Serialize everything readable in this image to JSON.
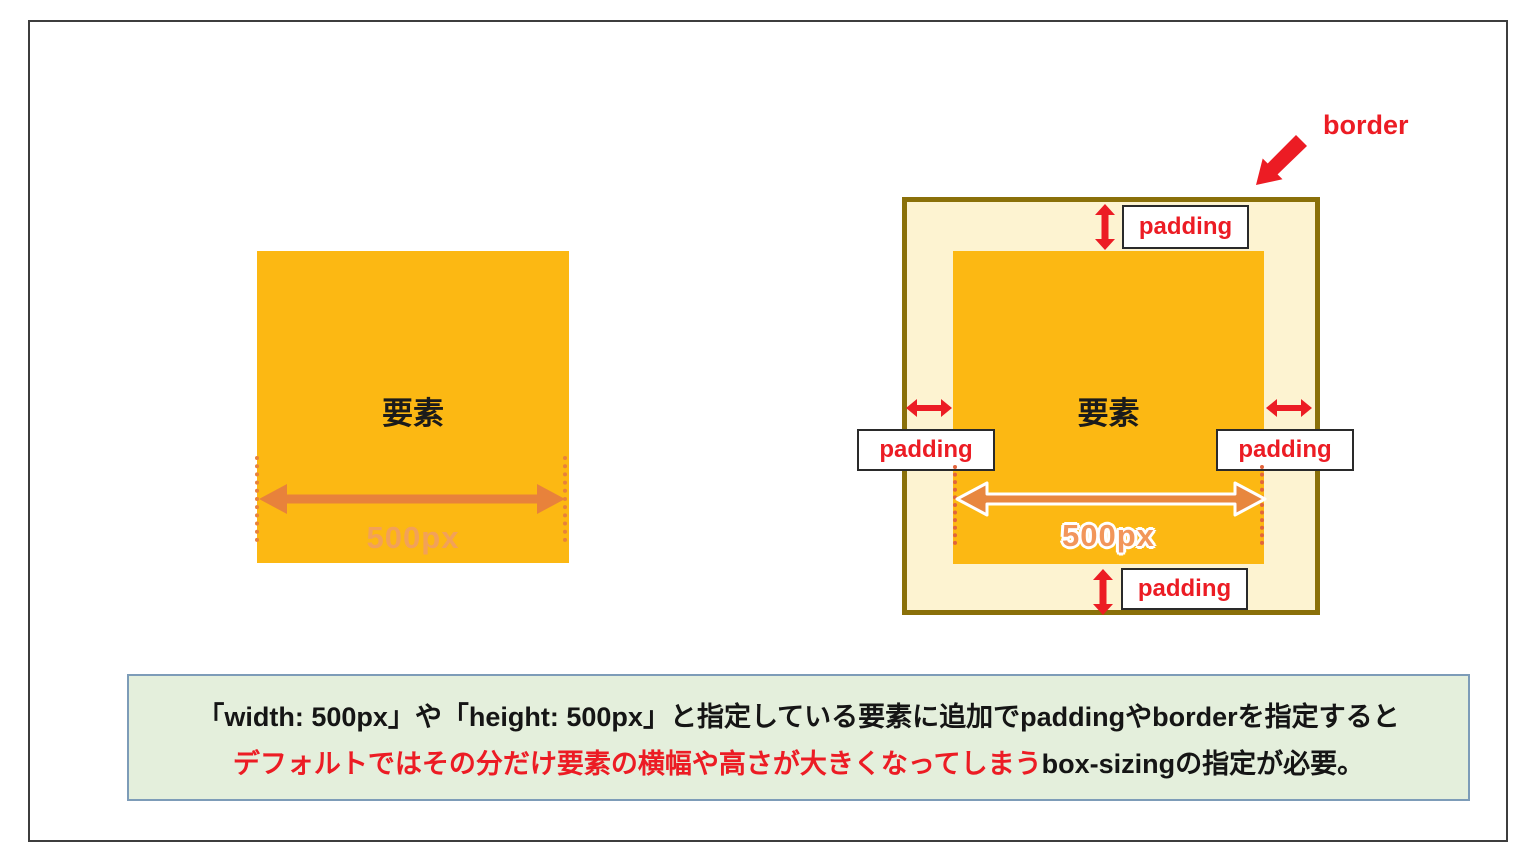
{
  "left_diagram": {
    "element_label": "要素",
    "width_label": "500px"
  },
  "right_diagram": {
    "border_label": "border",
    "element_label": "要素",
    "width_label": "500px",
    "padding_top": "padding",
    "padding_left": "padding",
    "padding_right": "padding",
    "padding_bottom": "padding"
  },
  "note": {
    "line1": "「width: 500px」や「height: 500px」と指定している要素に追加でpaddingやborderを指定すると",
    "line2_highlight": "デフォルトではその分だけ要素の横幅や高さが大きくなってしまう",
    "line2_rest": "box-sizingの指定が必要。"
  },
  "colors": {
    "element_fill": "#FCB813",
    "padding_fill": "#FDF3D1",
    "border_stroke": "#8A7009",
    "accent_red": "#EC1C24",
    "arrow_orange": "#E8823B",
    "size_label_orange": "#F2A159",
    "note_bg": "#E4EFDC",
    "note_border": "#7D9CB8",
    "frame_border": "#3D3D3D"
  }
}
